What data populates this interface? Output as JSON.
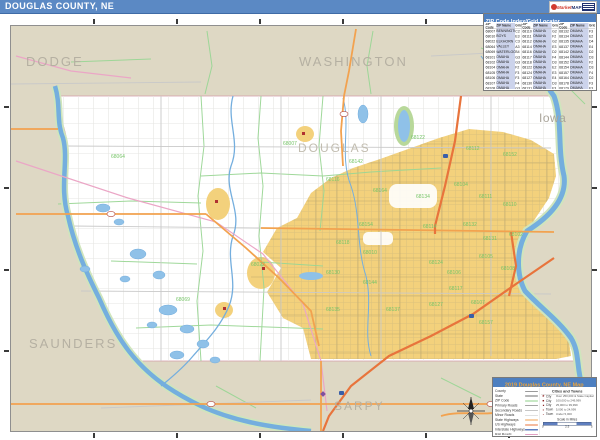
{
  "header": {
    "title": "DOUGLAS COUNTY, NE",
    "logo": {
      "market": "Market",
      "maps": "MAPS"
    }
  },
  "zip_table": {
    "title": "ZIP Code Index/Grid Locator",
    "col_headers": [
      "ZIP Code",
      "ZIP Name",
      "Grid"
    ],
    "groups": [
      {
        "rows": [
          {
            "zip": "68007",
            "name": "BENNINGTON",
            "grid": "C2"
          },
          {
            "zip": "68010",
            "name": "BOYS TOWN",
            "grid": "E3"
          },
          {
            "zip": "68022",
            "name": "ELKHORN",
            "grid": "C3"
          },
          {
            "zip": "68064",
            "name": "VALLEY",
            "grid": "A3"
          },
          {
            "zip": "68069",
            "name": "WATERLOO",
            "grid": "B4"
          },
          {
            "zip": "68101",
            "name": "OMAHA",
            "grid": "G3"
          },
          {
            "zip": "68102",
            "name": "OMAHA",
            "grid": "G3"
          },
          {
            "zip": "68104",
            "name": "OMAHA",
            "grid": "F2"
          },
          {
            "zip": "68105",
            "name": "OMAHA",
            "grid": "F3"
          },
          {
            "zip": "68106",
            "name": "OMAHA",
            "grid": "F3"
          },
          {
            "zip": "68107",
            "name": "OMAHA",
            "grid": "F4"
          },
          {
            "zip": "68108",
            "name": "OMAHA",
            "grid": "G3"
          }
        ]
      },
      {
        "rows": [
          {
            "zip": "68110",
            "name": "OMAHA",
            "grid": "G2"
          },
          {
            "zip": "68111",
            "name": "OMAHA",
            "grid": "F2"
          },
          {
            "zip": "68112",
            "name": "OMAHA",
            "grid": "G2"
          },
          {
            "zip": "68114",
            "name": "OMAHA",
            "grid": "E3"
          },
          {
            "zip": "68116",
            "name": "OMAHA",
            "grid": "D2"
          },
          {
            "zip": "68117",
            "name": "OMAHA",
            "grid": "F4"
          },
          {
            "zip": "68118",
            "name": "OMAHA",
            "grid": "D3"
          },
          {
            "zip": "68122",
            "name": "OMAHA",
            "grid": "E2"
          },
          {
            "zip": "68124",
            "name": "OMAHA",
            "grid": "E3"
          },
          {
            "zip": "68127",
            "name": "OMAHA",
            "grid": "E4"
          },
          {
            "zip": "68130",
            "name": "OMAHA",
            "grid": "D3"
          },
          {
            "zip": "68131",
            "name": "OMAHA",
            "grid": "F3"
          }
        ]
      },
      {
        "rows": [
          {
            "zip": "68132",
            "name": "OMAHA",
            "grid": "F3"
          },
          {
            "zip": "68134",
            "name": "OMAHA",
            "grid": "E2"
          },
          {
            "zip": "68135",
            "name": "OMAHA",
            "grid": "D4"
          },
          {
            "zip": "68137",
            "name": "OMAHA",
            "grid": "E4"
          },
          {
            "zip": "68142",
            "name": "OMAHA",
            "grid": "D2"
          },
          {
            "zip": "68144",
            "name": "OMAHA",
            "grid": "D3"
          },
          {
            "zip": "68152",
            "name": "OMAHA",
            "grid": "F2"
          },
          {
            "zip": "68154",
            "name": "OMAHA",
            "grid": "D3"
          },
          {
            "zip": "68157",
            "name": "OMAHA",
            "grid": "F4"
          },
          {
            "zip": "68164",
            "name": "OMAHA",
            "grid": "D2"
          },
          {
            "zip": "68178",
            "name": "OMAHA",
            "grid": "F3"
          },
          {
            "zip": "68179",
            "name": "OMAHA",
            "grid": "F3"
          }
        ]
      }
    ]
  },
  "legend": {
    "title": "2019 Douglas County, NE Map",
    "lines": [
      {
        "label": "County",
        "color": "#9a9a9a",
        "w": "1.5px"
      },
      {
        "label": "State",
        "color": "#6e6e6e",
        "w": "2px"
      },
      {
        "label": "ZIP Code",
        "color": "#8fd08a",
        "w": "2px"
      },
      {
        "label": "Primary Roads",
        "color": "#4a4a4a",
        "w": "1.5px"
      },
      {
        "label": "Secondary Roads",
        "color": "#8d8d8d",
        "w": "1px"
      },
      {
        "label": "Minor Roads",
        "color": "#c0c0c0",
        "w": "1px"
      },
      {
        "label": "State Highways",
        "color": "#f2a24f",
        "w": "2px"
      },
      {
        "label": "US Highways",
        "color": "#e8743c",
        "w": "2px"
      },
      {
        "label": "Interstate Highways",
        "color": "#5f7fc0",
        "w": "2.5px"
      },
      {
        "label": "Rail Roads",
        "color": "#e2a0c4",
        "w": "1.5px"
      }
    ],
    "cities_header": "Cities and Towns",
    "cities": [
      {
        "sym": "★",
        "type": "City",
        "range": "Over 250,000 & State Capital",
        "size": "7px"
      },
      {
        "sym": "■",
        "type": "City",
        "range": "100,000 to 249,999",
        "size": "6px"
      },
      {
        "sym": "■",
        "type": "City",
        "range": "25,000 to 99,999",
        "size": "5px"
      },
      {
        "sym": "■",
        "type": "Town",
        "range": "5,000 to 24,999",
        "size": "4px"
      },
      {
        "sym": "■",
        "type": "Town",
        "range": "Under 5,000",
        "size": "3px"
      }
    ],
    "scale": {
      "label": "Scale in Miles",
      "ticks": [
        "0",
        "2.5",
        "5"
      ]
    }
  },
  "map": {
    "county_labels": [
      {
        "text": "DODGE",
        "x": 15,
        "y": 40,
        "size": 13,
        "ls": 2,
        "color": "#b5b0a2"
      },
      {
        "text": "WASHINGTON",
        "x": 288,
        "y": 40,
        "size": 13,
        "ls": 2,
        "color": "#b5b0a2"
      },
      {
        "text": "Iowa",
        "x": 528,
        "y": 96,
        "size": 12,
        "ls": 0.5,
        "color": "#a9a49a"
      },
      {
        "text": "DOUGLAS",
        "x": 287,
        "y": 126,
        "size": 12,
        "ls": 2,
        "color": "#c2bdb0"
      },
      {
        "text": "SAUNDERS",
        "x": 18,
        "y": 322,
        "size": 13,
        "ls": 2,
        "color": "#b5b0a2"
      },
      {
        "text": "SARPY",
        "x": 323,
        "y": 384,
        "size": 12,
        "ls": 2,
        "color": "#b5b0a2"
      }
    ],
    "zip_label_color": "#76c468",
    "zip_labels": [
      {
        "t": "68064",
        "x": 100,
        "y": 132
      },
      {
        "t": "68007",
        "x": 272,
        "y": 119
      },
      {
        "t": "68122",
        "x": 400,
        "y": 113
      },
      {
        "t": "68112",
        "x": 455,
        "y": 124
      },
      {
        "t": "68152",
        "x": 492,
        "y": 130
      },
      {
        "t": "68142",
        "x": 338,
        "y": 137
      },
      {
        "t": "68116",
        "x": 315,
        "y": 155
      },
      {
        "t": "68164",
        "x": 362,
        "y": 166
      },
      {
        "t": "68134",
        "x": 405,
        "y": 172
      },
      {
        "t": "68104",
        "x": 443,
        "y": 160
      },
      {
        "t": "68111",
        "x": 468,
        "y": 172
      },
      {
        "t": "68110",
        "x": 492,
        "y": 180
      },
      {
        "t": "68154",
        "x": 348,
        "y": 200
      },
      {
        "t": "68114",
        "x": 412,
        "y": 202
      },
      {
        "t": "68132",
        "x": 452,
        "y": 200
      },
      {
        "t": "68131",
        "x": 472,
        "y": 214
      },
      {
        "t": "68102",
        "x": 498,
        "y": 210
      },
      {
        "t": "68118",
        "x": 325,
        "y": 218
      },
      {
        "t": "68010",
        "x": 352,
        "y": 228
      },
      {
        "t": "68022",
        "x": 240,
        "y": 240
      },
      {
        "t": "68144",
        "x": 352,
        "y": 258
      },
      {
        "t": "68124",
        "x": 418,
        "y": 238
      },
      {
        "t": "68105",
        "x": 468,
        "y": 232
      },
      {
        "t": "68106",
        "x": 436,
        "y": 248
      },
      {
        "t": "68108",
        "x": 490,
        "y": 244
      },
      {
        "t": "68069",
        "x": 165,
        "y": 275
      },
      {
        "t": "68130",
        "x": 315,
        "y": 248
      },
      {
        "t": "68135",
        "x": 315,
        "y": 285
      },
      {
        "t": "68137",
        "x": 375,
        "y": 285
      },
      {
        "t": "68127",
        "x": 418,
        "y": 280
      },
      {
        "t": "68117",
        "x": 438,
        "y": 264
      },
      {
        "t": "68107",
        "x": 460,
        "y": 278
      },
      {
        "t": "68157",
        "x": 468,
        "y": 298
      }
    ],
    "grid_ticks": {
      "top": [
        83,
        166,
        249,
        332,
        415,
        498
      ],
      "side": [
        81,
        162,
        244,
        325
      ]
    },
    "colors": {
      "titlebar_blue": "#5b89c4",
      "table_header_blue": "#4d7fc0",
      "legend_title_orange": "#e9a23b",
      "neighbor_county_bg": "#ded8c4",
      "douglas_county_bg": "#ffffff",
      "urban_area": "#f3d17c",
      "water": "#74aede",
      "water_bank": "#cfe5bd",
      "zip_boundary_green": "#9ad695",
      "highway_orange": "#f2a24f",
      "interstate_red": "#e8743c",
      "railroad_pink": "#eba6c6",
      "table_stripe_lavender": "#ccd3eb"
    }
  }
}
